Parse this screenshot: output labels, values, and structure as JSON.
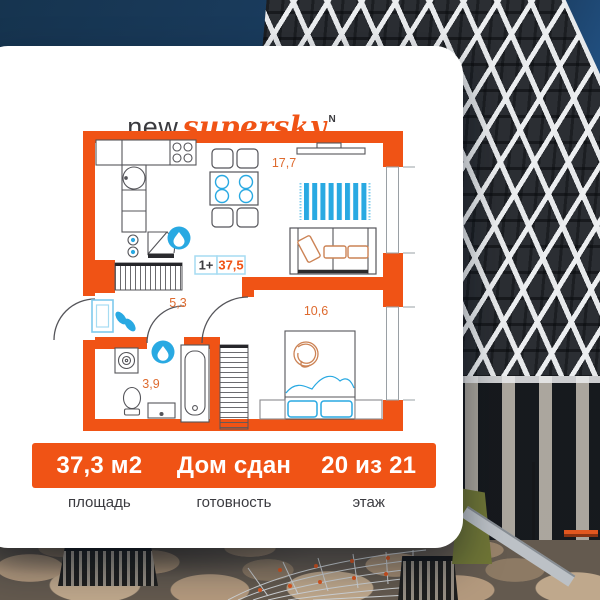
{
  "logo": {
    "prefix": "new",
    "brand": "supersky",
    "mark": "N"
  },
  "floor_plan": {
    "badge": {
      "rooms": "1+",
      "total_area": "37,5"
    },
    "room_areas": {
      "living": "17,7",
      "hall": "5,3",
      "bath": "3,9",
      "bedroom": "10,6"
    }
  },
  "stats": {
    "items": [
      {
        "value": "37,3 м2",
        "label": "площадь"
      },
      {
        "value": "Дом сдан",
        "label": "готовность"
      },
      {
        "value": "20 из 21",
        "label": "этаж"
      }
    ]
  },
  "colors": {
    "accent": "#F05315",
    "blue": "#29A9E2"
  }
}
